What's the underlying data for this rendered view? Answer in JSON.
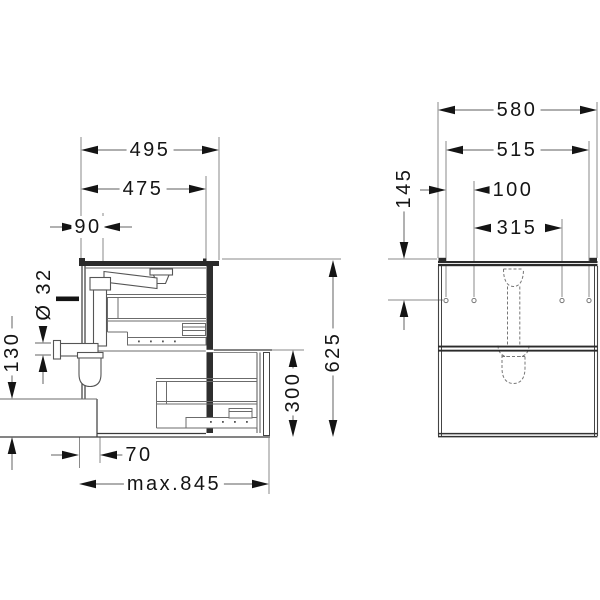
{
  "drawing": {
    "kind": "technical-dimension-drawing",
    "views": {
      "side_view": "side-section-of-vanity-with-siphon-and-open-drawer",
      "front_view": "front-elevation-with-mounting-holes-and-drain-template"
    }
  },
  "dimensions": {
    "side_view": {
      "width_total": "495",
      "width_carcass": "475",
      "drain_offset": "90",
      "pipe_diameter": "Ø 32",
      "recess_height": "130",
      "height_total": "625",
      "lower_front_height": "300",
      "recess_depth": "70",
      "depth_max": "max.845"
    },
    "front_view": {
      "width_total": "580",
      "hole_span": "515",
      "hole_offset": "100",
      "hole_spacing": "315",
      "hole_drop": "145"
    }
  },
  "colors": {
    "background": "#ffffff",
    "line_dark": "#2b2b2b",
    "line_mid": "#555555",
    "line_light": "#6b6b6b",
    "dim_line": "#7d7d7d",
    "ext_line": "#8a8a8a",
    "arrow_and_text": "#141414"
  }
}
